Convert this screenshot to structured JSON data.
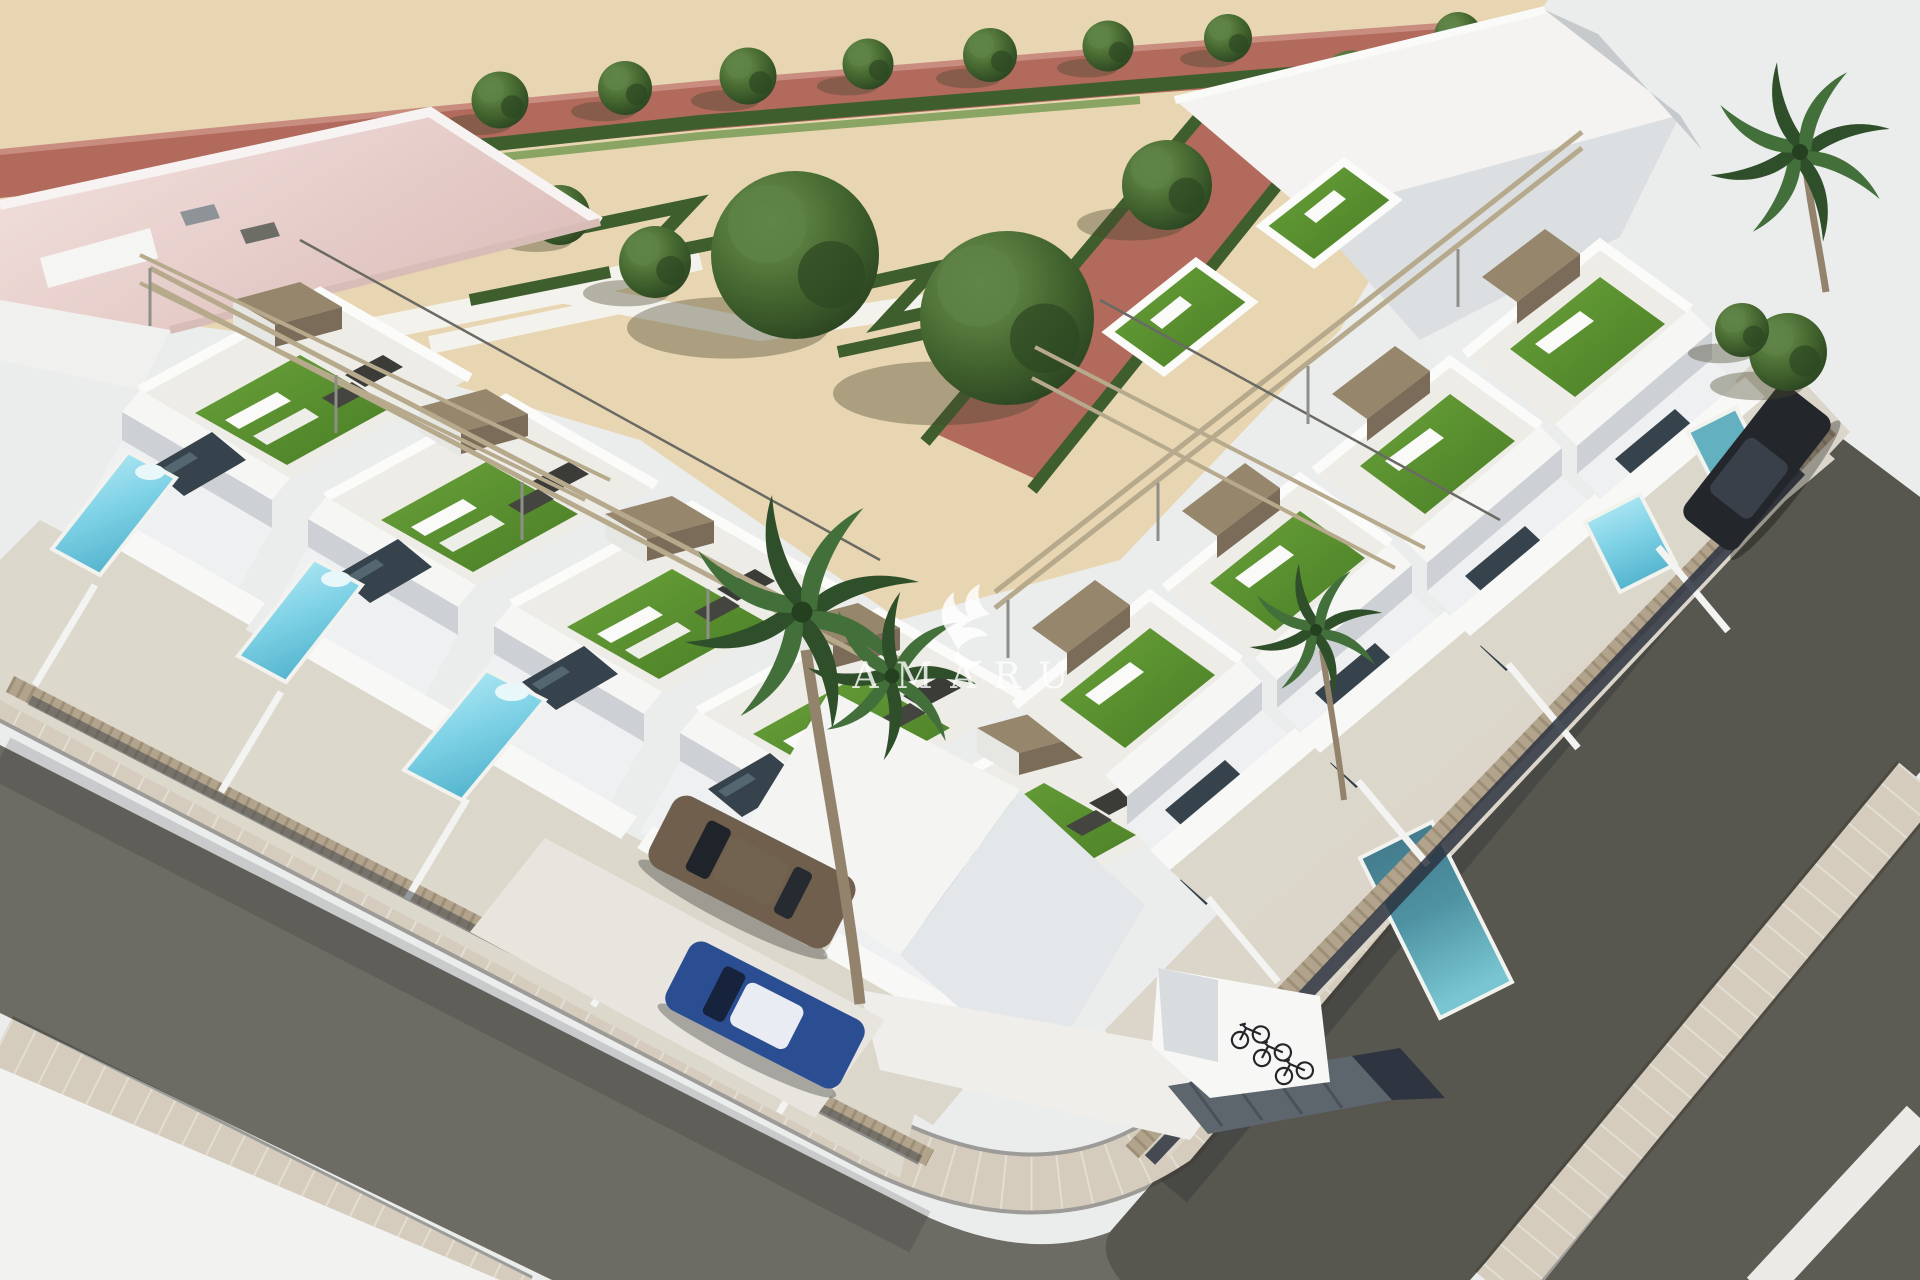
{
  "scene": {
    "title": "Aerial 3D architectural render of a modern white townhouse development",
    "watermark": {
      "brand": "AMARU",
      "display_text": "A M A R U",
      "logo": "griffin-flourish-icon"
    },
    "inventory": {
      "townhouse_rows": 2,
      "left_row_units": 5,
      "right_row_units": 4,
      "rooftop_terraces_with_turf": 8,
      "private_pools": 6,
      "streets": 2,
      "cars": [
        {
          "color_name": "bronze"
        },
        {
          "color_name": "blue"
        },
        {
          "color_name": "dark-gray"
        }
      ],
      "bicycles": 3,
      "palm_trees": 4,
      "park_trees": 15,
      "park_style": "formal parterre with angular hedges and terracotta paths"
    },
    "palette": {
      "background": "#ebecec",
      "sand": "#e8d6b2",
      "path_red": "#b16a5c",
      "path_red_light": "#c98d80",
      "hedge_green": "#3f5e2e",
      "tree_green": "#35522a",
      "turf_green": "#57892f",
      "wall_white": "#f5f5f3",
      "wall_shade": "#c7cbd0",
      "glass_dark": "#38444e",
      "beam_tan": "#b6a98c",
      "fence_beige": "#b2a38c",
      "pool_light": "#7fd2e6",
      "pool_teal": "#4f93a3",
      "asphalt": "#6d6c64",
      "asphalt_dark": "#57564f",
      "paver": "#d5ccbd",
      "pavement_light": "#f2f2f0",
      "roof_pink": "#e9cfcb",
      "car_bronze": "#6f5f4c",
      "car_blue": "#2b4d92",
      "car_dark": "#23262b"
    }
  }
}
